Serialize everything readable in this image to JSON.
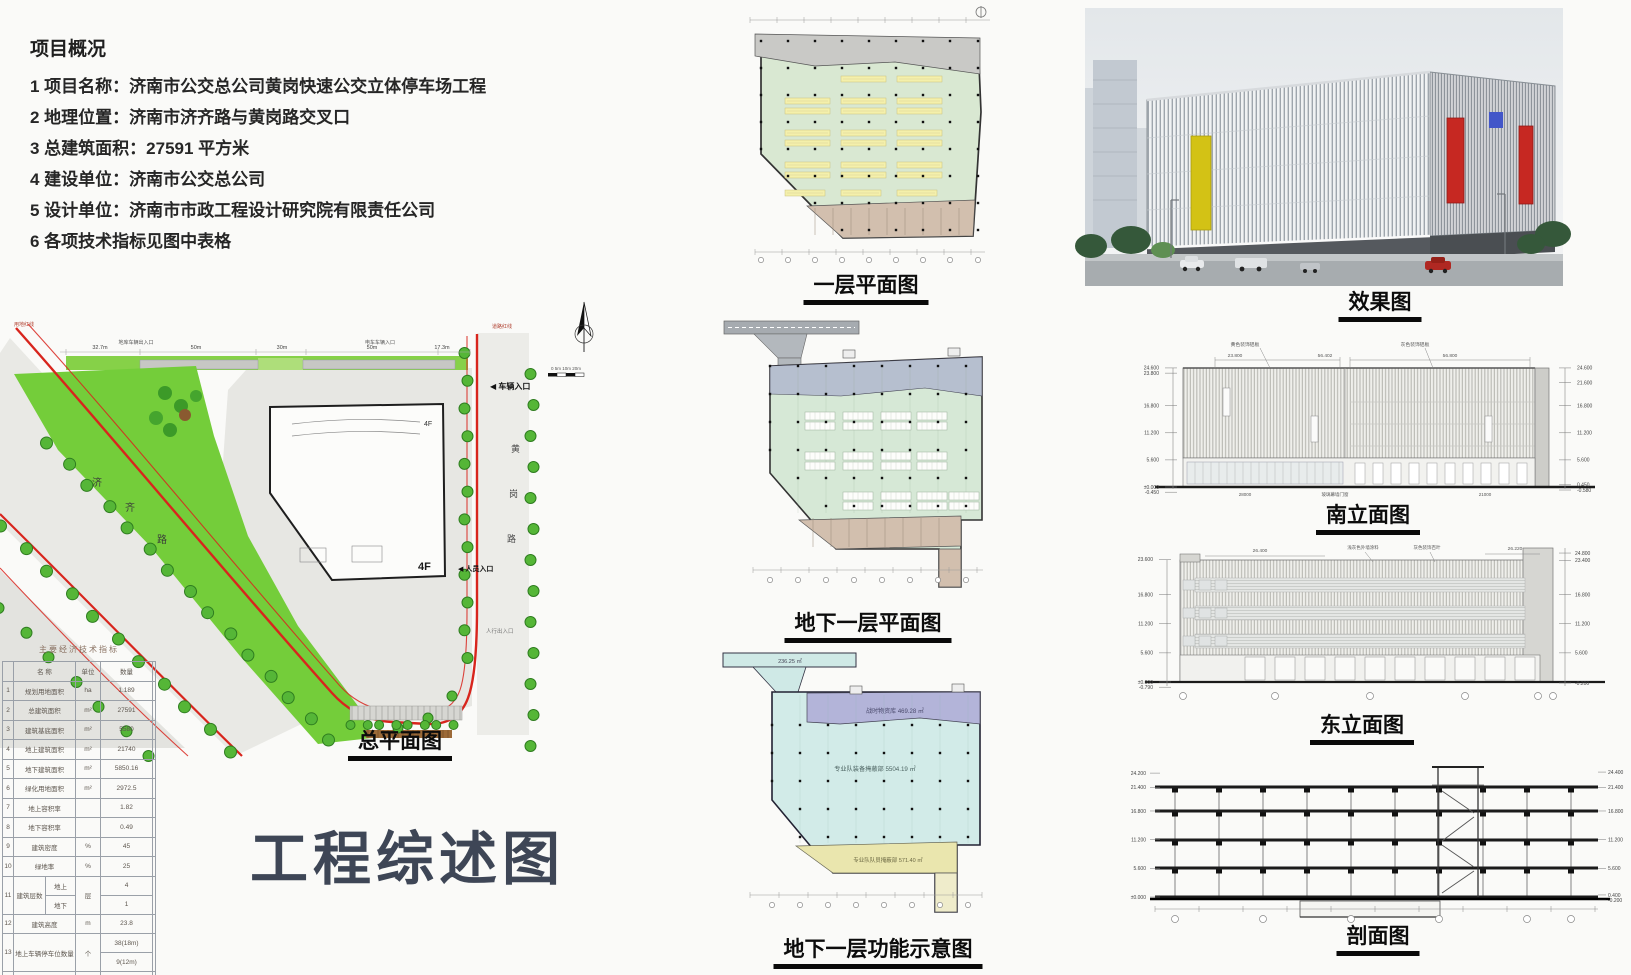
{
  "board": {
    "main_title": "工程综述图"
  },
  "overview": {
    "title": "项目概况",
    "items": [
      "1 项目名称：济南市公交总公司黄岗快速公交立体停车场工程",
      "2 地理位置：济南市济齐路与黄岗路交叉口",
      "3 总建筑面积：27591 平方米",
      "4 建设单位：济南市公交总公司",
      "5 设计单位：济南市市政工程设计研究院有限责任公司",
      "6 各项技术指标见图中表格"
    ]
  },
  "titles": {
    "site": "总平面图",
    "plan1": "一层平面图",
    "plan2": "地下一层平面图",
    "plan3": "地下一层功能示意图",
    "render": "效果图",
    "south": "南立面图",
    "east": "东立面图",
    "section": "剖面图"
  },
  "site_plan": {
    "road_left_chars": [
      "济",
      "齐",
      "路"
    ],
    "road_right_chars": [
      "黄",
      "岗",
      "路"
    ],
    "labels": {
      "vehicle_entrance": "◀ 车辆入口",
      "people_entrance": "◀ 人员入口",
      "ped_entrance": "人行出入口",
      "garage_out": "地库车辆出入口",
      "garage_in": "电车车辆入口",
      "floors": "4F",
      "redline_left": "用地红线",
      "redline_right": "道路红线"
    },
    "top_dims": [
      "32.7m",
      "50m",
      "30m",
      "50m",
      "17.3m"
    ],
    "scale_text": "0  5m 10m    20m"
  },
  "table": {
    "title": "主要经济技术指标",
    "headers": [
      "名  称",
      "单位",
      "数量"
    ],
    "rows": [
      {
        "no": "1",
        "name": "规划用地面积",
        "unit": "ha",
        "qty": "1.189"
      },
      {
        "no": "2",
        "name": "总建筑面积",
        "unit": "m²",
        "qty": "27591"
      },
      {
        "no": "3",
        "name": "建筑基底面积",
        "unit": "m²",
        "qty": "5580"
      },
      {
        "no": "4",
        "name": "地上建筑面积",
        "unit": "m²",
        "qty": "21740"
      },
      {
        "no": "5",
        "name": "地下建筑面积",
        "unit": "m²",
        "qty": "5850.16"
      },
      {
        "no": "6",
        "name": "绿化用地面积",
        "unit": "m²",
        "qty": "2972.5"
      },
      {
        "no": "7",
        "name": "地上容积率",
        "unit": "",
        "qty": "1.82"
      },
      {
        "no": "8",
        "name": "地下容积率",
        "unit": "",
        "qty": "0.49"
      },
      {
        "no": "9",
        "name": "建筑密度",
        "unit": "%",
        "qty": "45"
      },
      {
        "no": "10",
        "name": "绿地率",
        "unit": "%",
        "qty": "25"
      },
      {
        "no": "11",
        "name": "建筑层数",
        "unit": "层",
        "sub": [
          {
            "k": "地上",
            "v": "4"
          },
          {
            "k": "地下",
            "v": "1"
          }
        ]
      },
      {
        "no": "12",
        "name": "建筑高度",
        "unit": "m",
        "qty": "23.8"
      },
      {
        "no": "13",
        "name": "地上车辆停车位数量",
        "unit": "个",
        "qty2": [
          "38(18m)",
          "9(12m)"
        ]
      },
      {
        "no": "14",
        "name": "地下车辆停车位数量",
        "unit": "个",
        "qty": "26(12m)"
      },
      {
        "no": "15",
        "name": "小型汽车停车位数量",
        "unit": "个",
        "qty": "41"
      }
    ]
  },
  "plan3": {
    "ramp_area": "236.25 ㎡",
    "purple_label": "战时物资库 469.28 ㎡",
    "cyan_label": "专业队装备掩蔽部 5504.19 ㎡",
    "yellow_label": "专业队队员掩蔽部 571.40 ㎡"
  },
  "south_elev": {
    "top_dims": [
      "23.800",
      "56.402",
      "56.800"
    ],
    "annotations": [
      "黄色装饰铝板",
      "灰色装饰铝板"
    ],
    "bottom_label": "玻璃幕墙门窗",
    "bottom_dims": [
      "28000",
      "21000"
    ],
    "left_marks": [
      "24.600",
      "23.800",
      "16.800",
      "11.200",
      "5.600",
      "±0.000",
      "-0.450"
    ],
    "right_marks": [
      "24.600",
      "21.600",
      "16.800",
      "11.200",
      "5.600",
      "0.450",
      "-0.580"
    ]
  },
  "east_elev": {
    "top_dims": [
      "26.400",
      "26.220"
    ],
    "annotations": [
      "浅灰色外墙涂料",
      "灰色装饰百叶"
    ],
    "left_marks": [
      "23.600",
      "16.800",
      "11.200",
      "5.600",
      "±0.000",
      "-0.790"
    ],
    "right_marks": [
      "24.800",
      "23.400",
      "16.800",
      "11.200",
      "5.600",
      "-0.200"
    ]
  },
  "section": {
    "left_marks": [
      "24.200",
      "21.400",
      "16.800",
      "11.200",
      "5.600",
      "±0.000"
    ],
    "right_marks": [
      "24.400",
      "21.400",
      "16.800",
      "11.200",
      "5.600",
      "0.400",
      "-0.200"
    ]
  }
}
